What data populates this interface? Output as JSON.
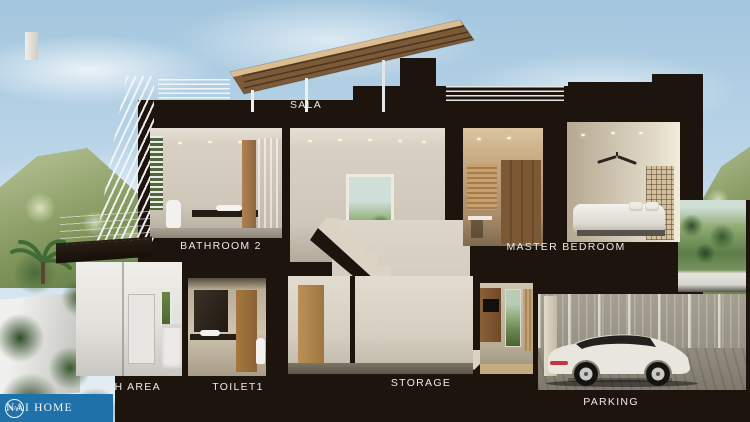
{
  "scene": {
    "type": "3d-house-cross-section-render",
    "floors": 2
  },
  "labels": {
    "sala": "SALA",
    "bathroom2": "BATHROOM 2",
    "master_bedroom": "MASTER BEDROOM",
    "wash_area": "WASH AREA",
    "toilet1": "TOILET1",
    "storage": "STORAGE",
    "parking": "PARKING"
  },
  "watermark": {
    "badge": "NAI",
    "name": "NAI HOME"
  },
  "colors": {
    "logo_blue": "#1f72a9",
    "cut": "#1d140e",
    "label": "#eceae6"
  }
}
